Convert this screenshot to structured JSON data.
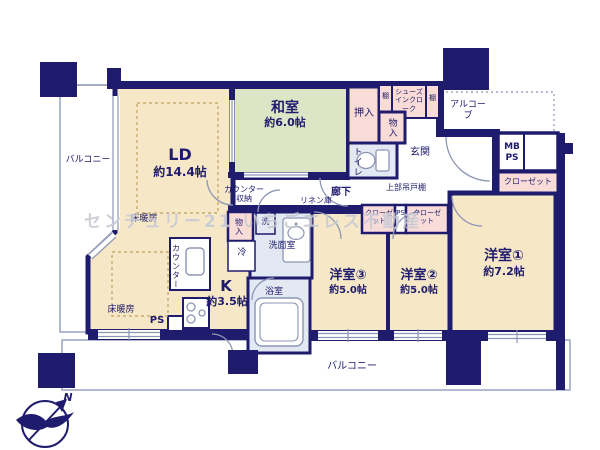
{
  "floorplan": {
    "rooms": {
      "ld": {
        "name": "LD",
        "size": "約14.4帖"
      },
      "washitsu": {
        "name": "和室",
        "size": "約6.0帖"
      },
      "kitchen": {
        "name": "K",
        "size": "約3.5帖"
      },
      "yoshitsu1": {
        "name": "洋室①",
        "size": "約7.2帖"
      },
      "yoshitsu2": {
        "name": "洋室②",
        "size": "約5.0帖"
      },
      "yoshitsu3": {
        "name": "洋室③",
        "size": "約5.0帖"
      }
    },
    "labels": {
      "balcony_left": "バルコニー",
      "balcony_bottom": "バルコニー",
      "genkan": "玄関",
      "alcove": "アルコーブ",
      "shoes_cloak": "シューズインクローク",
      "shelf_left": "棚",
      "shelf_right": "棚",
      "oshiire": "押入",
      "storage_top": "物入",
      "storage_kitchen": "物入",
      "toilet": "トイレ",
      "mb_ps": "MB PS",
      "closet_main": "クローゼット",
      "closet_mid_left": "クローゼット",
      "closet_mid_right": "クローゼット",
      "ps_mid": "PS",
      "ps_bottom": "PS",
      "upper_cabinet": "上部吊戸棚",
      "hallway": "廊下",
      "linen": "リネン庫",
      "counter_storage": "カウンター収納",
      "counter": "カウンター",
      "floor_heating_ld": "床暖房",
      "floor_heating_dining": "床暖房",
      "fridge": "冷",
      "washer": "洗",
      "washroom": "洗面室",
      "bathroom": "浴室",
      "north": "N"
    },
    "watermark": "センチュリー21 いちごエレス不動産",
    "colors": {
      "wall": "#1f1b6d",
      "room_cream": "#f6e8c6",
      "tatami_green": "#dce6c6",
      "storage_pink": "#f9dcd8",
      "wet_blue": "#e3e9f2",
      "line_gray": "#8d95b5"
    }
  }
}
